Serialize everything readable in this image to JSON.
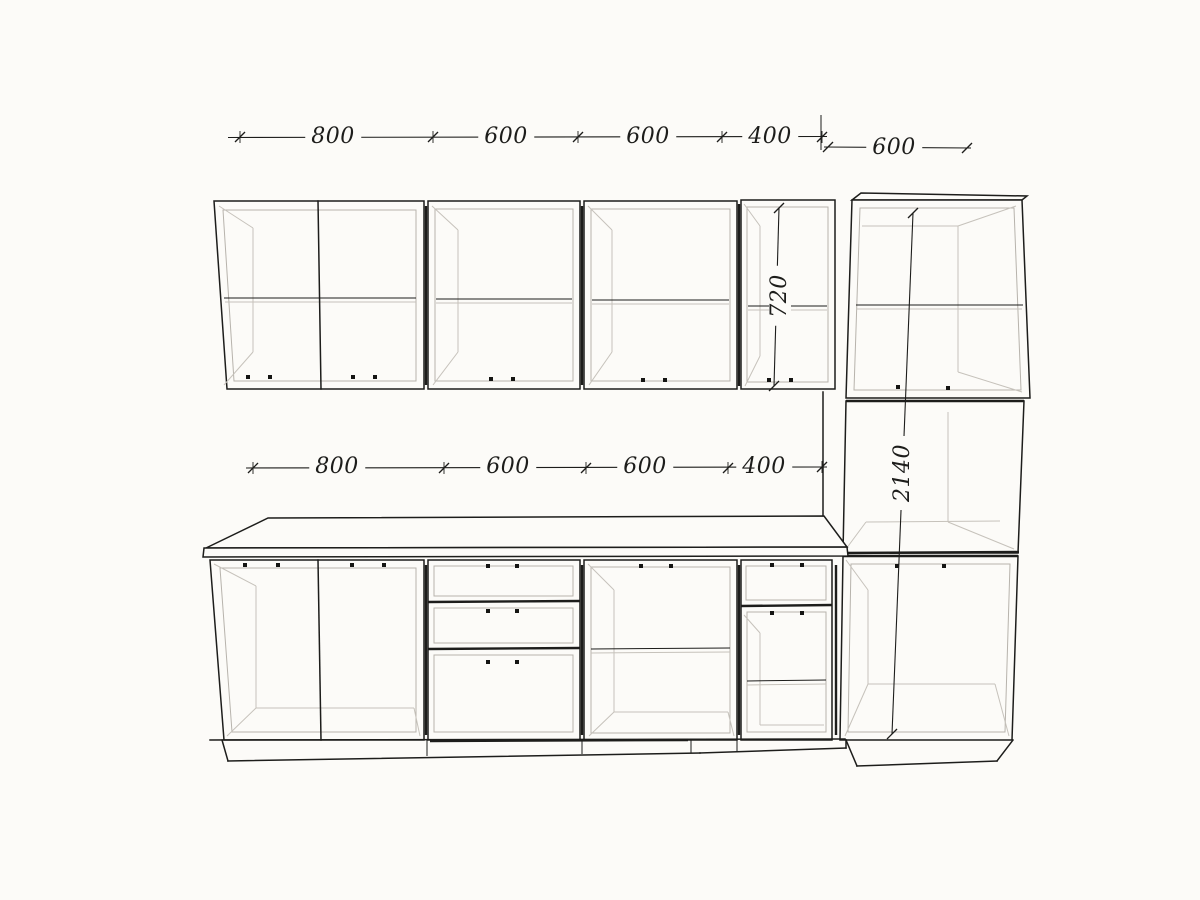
{
  "palette": {
    "background": "#fcfbf8",
    "ink": "#1d1d1b",
    "frame_line": "#b7b3ac",
    "faint_line": "#c6c2bb"
  },
  "drawing": {
    "kind": "kitchen-cabinet-elevation-line-drawing",
    "units": "mm",
    "upper_dimension_chain": [
      "800",
      "600",
      "600",
      "400"
    ],
    "tall_unit_top_width": "600",
    "base_dimension_chain": [
      "800",
      "600",
      "600",
      "400"
    ],
    "wall_cabinet_height": "720",
    "tall_unit_height": "2140"
  }
}
